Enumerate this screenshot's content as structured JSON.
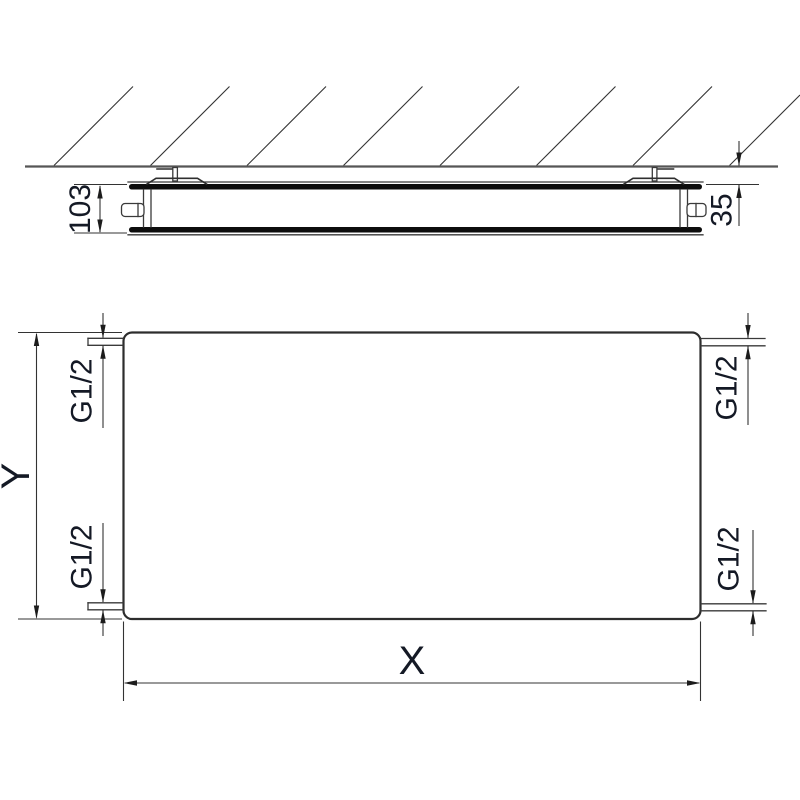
{
  "side_view": {
    "depth_label": "103",
    "wall_distance_label": "35"
  },
  "front_view": {
    "width_label": "X",
    "height_label": "Y",
    "connection_label": "G1/2"
  },
  "colors": {
    "background": "#ffffff",
    "line": "#3a3a3a",
    "heavy_line": "#0d0d0d",
    "wall_line": "#565656",
    "dimension_line": "#333333",
    "text": "#141925"
  }
}
